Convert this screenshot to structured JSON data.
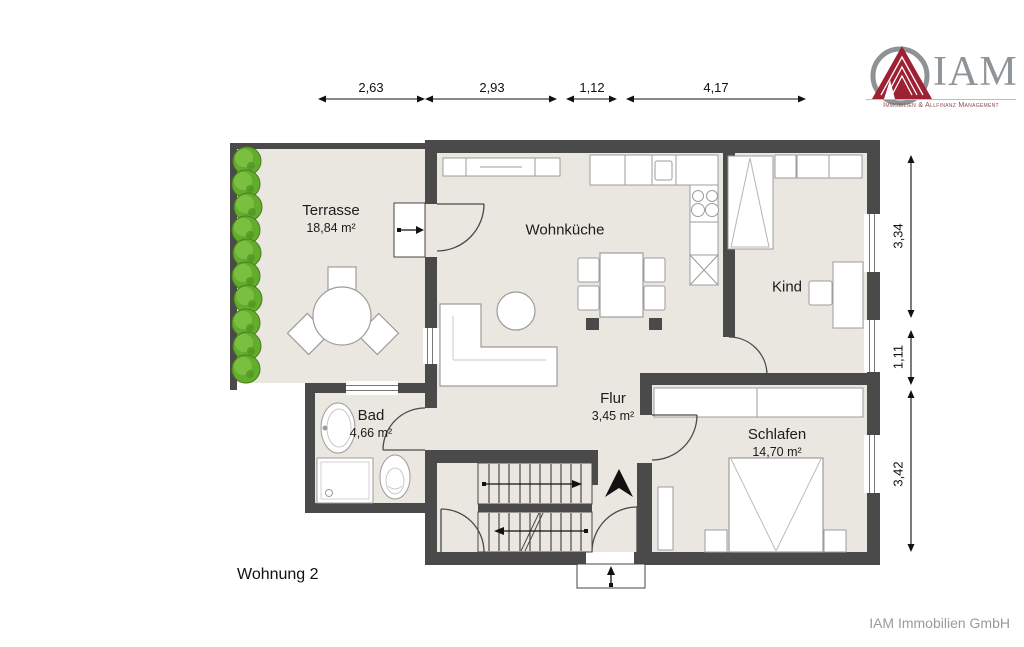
{
  "logo": {
    "brand": "IAM",
    "tagline": "Immobilien & Allfinanz Management",
    "mark": "pyramid-in-circle-icon"
  },
  "dimensions_top": [
    {
      "label": "2,63"
    },
    {
      "label": "2,93"
    },
    {
      "label": "1,12"
    },
    {
      "label": "4,17"
    }
  ],
  "dimensions_right": [
    {
      "label": "3,34"
    },
    {
      "label": "1,11"
    },
    {
      "label": "3,42"
    }
  ],
  "rooms": {
    "terrasse": {
      "name": "Terrasse",
      "area": "18,84 m²"
    },
    "wohnkueche": {
      "name": "Wohnküche"
    },
    "kind": {
      "name": "Kind"
    },
    "bad": {
      "name": "Bad",
      "area": "4,66 m²"
    },
    "flur": {
      "name": "Flur",
      "area": "3,45 m²"
    },
    "schlafen": {
      "name": "Schlafen",
      "area": "14,70 m²"
    }
  },
  "footer": {
    "unit_label": "Wohnung 2",
    "company": "IAM Immobilien GmbH"
  },
  "colors": {
    "wall": "#4a4a4a",
    "floor": "#eae6e0",
    "bush_green": "#63ad2d",
    "logo_red": "#9e2033",
    "logo_gray": "#8f9499"
  }
}
